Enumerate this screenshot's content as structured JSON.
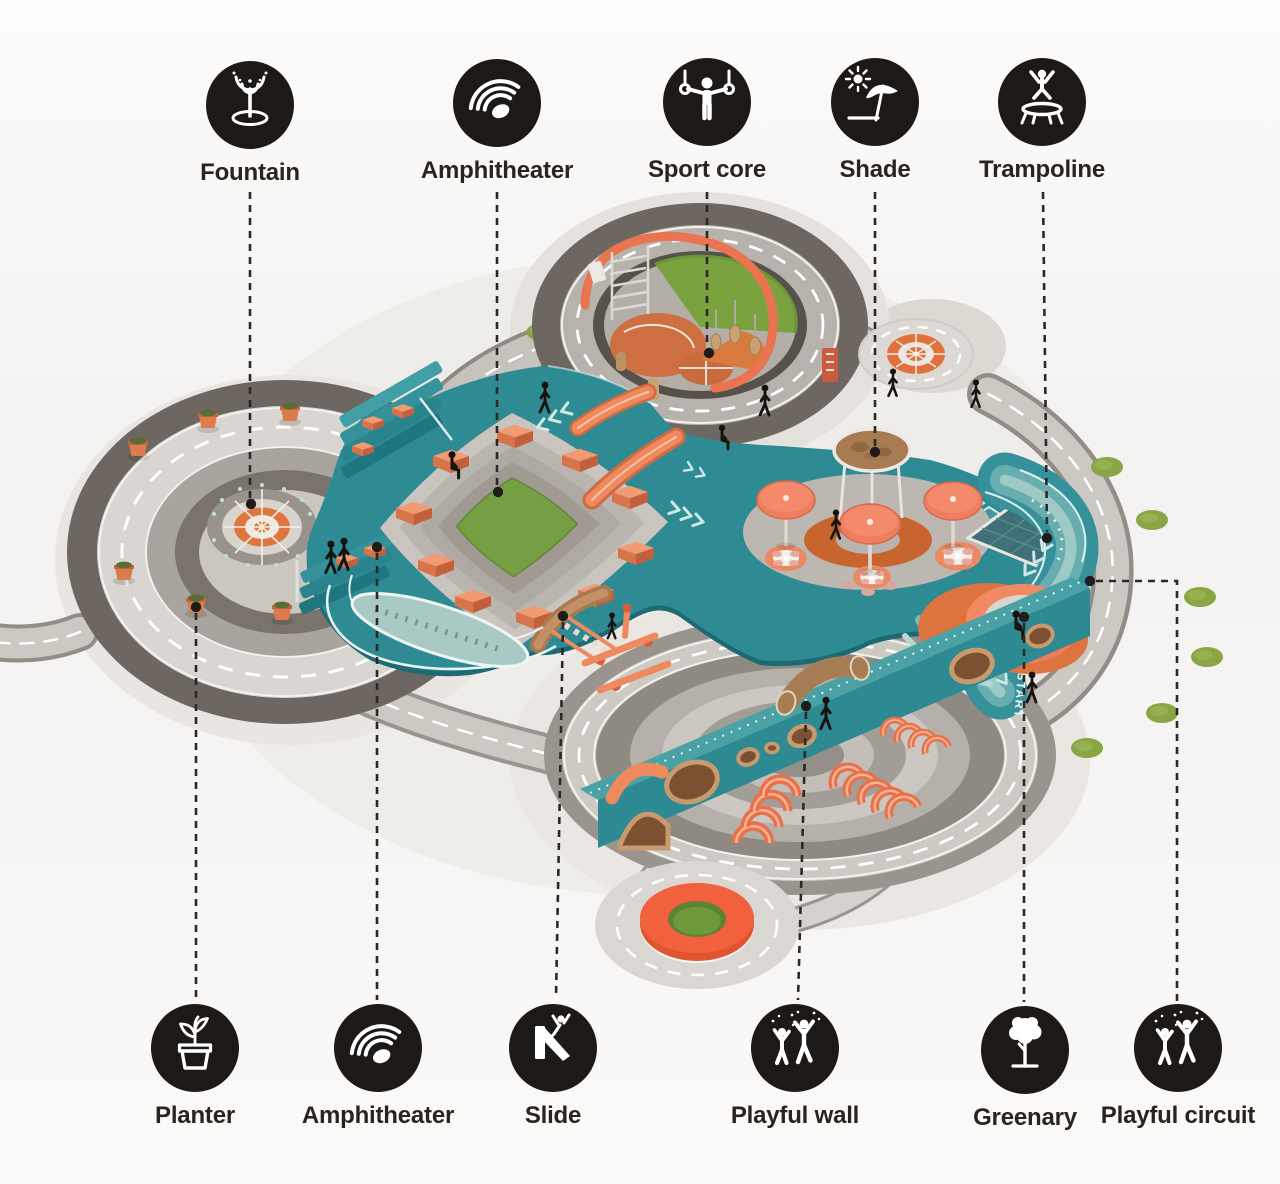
{
  "legend_top": [
    {
      "id": "fountain",
      "label": "Fountain"
    },
    {
      "id": "amphitheater",
      "label": "Amphitheater"
    },
    {
      "id": "sport-core",
      "label": "Sport core"
    },
    {
      "id": "shade",
      "label": "Shade"
    },
    {
      "id": "trampoline",
      "label": "Trampoline"
    }
  ],
  "legend_bottom": [
    {
      "id": "planter",
      "label": "Planter"
    },
    {
      "id": "amphitheater",
      "label": "Amphitheater"
    },
    {
      "id": "slide",
      "label": "Slide"
    },
    {
      "id": "playful-wall",
      "label": "Playful wall"
    },
    {
      "id": "greenary",
      "label": "Greenary"
    },
    {
      "id": "playful-circuit",
      "label": "Playful circuit"
    }
  ],
  "illustration": {
    "ground_texts": {
      "jump": "JUMP",
      "start": "START"
    },
    "palette": {
      "teal": "#2e8b93",
      "teal_dark": "#1d6a73",
      "orange": "#ee8259",
      "coral": "#ef7e5f",
      "terracotta": "#c8652f",
      "orange_ring": "#f2613e",
      "turf_green": "#76a043",
      "bush_green": "#8aa544",
      "road_gray": "#ccc8c2",
      "dark_ring": "#6e6761",
      "ink": "#1c1917"
    }
  }
}
